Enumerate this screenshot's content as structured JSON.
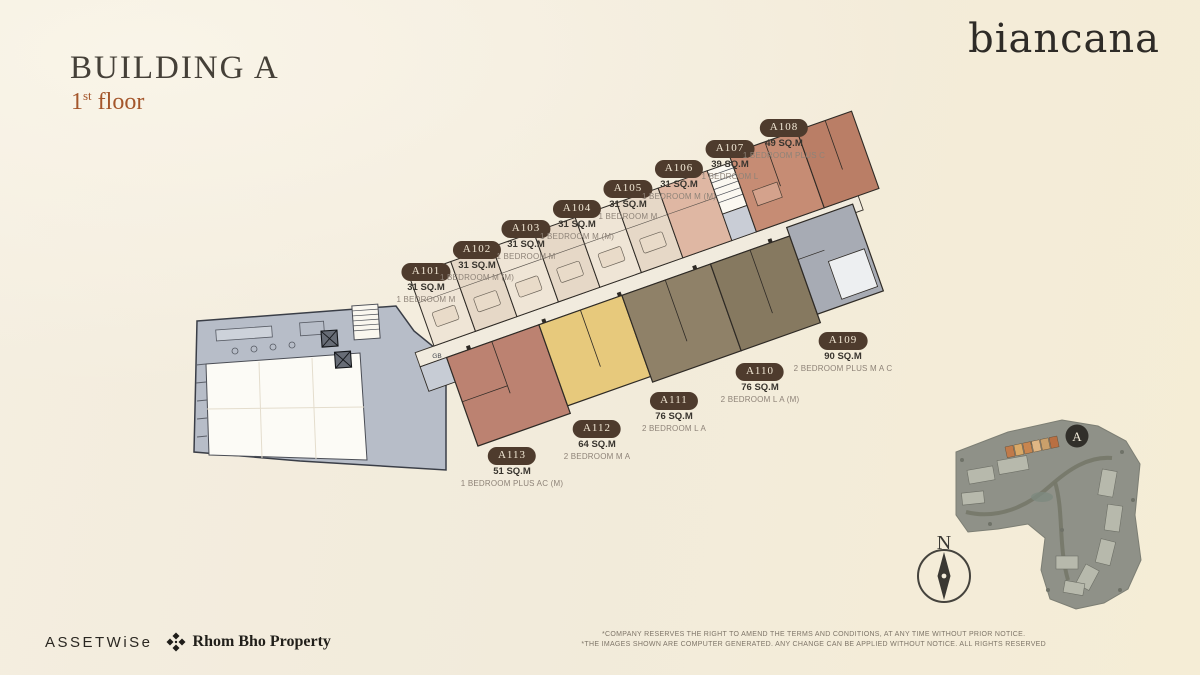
{
  "header": {
    "title": "BUILDING A",
    "floor_number": "1",
    "floor_ordinal": "st",
    "floor_word": "floor"
  },
  "brand": {
    "name": "biancana"
  },
  "units": [
    {
      "id": "A101",
      "sqm": "31 SQ.M",
      "type": "1 BEDROOM M"
    },
    {
      "id": "A102",
      "sqm": "31 SQ.M",
      "type": "1 BEDROOM M (M)"
    },
    {
      "id": "A103",
      "sqm": "31 SQ.M",
      "type": "1 BEDROOM M"
    },
    {
      "id": "A104",
      "sqm": "31 SQ.M",
      "type": "1 BEDROOM M (M)"
    },
    {
      "id": "A105",
      "sqm": "31 SQ.M",
      "type": "1 BEDROOM M"
    },
    {
      "id": "A106",
      "sqm": "31 SQ.M",
      "type": "1 BEDROOM M (M)"
    },
    {
      "id": "A107",
      "sqm": "39 SQ.M",
      "type": "1 BEDROOM L"
    },
    {
      "id": "A108",
      "sqm": "49 SQ.M",
      "type": "1 BEDROOM PLUS C"
    },
    {
      "id": "A109",
      "sqm": "90 SQ.M",
      "type": "2 BEDROOM PLUS M A C"
    },
    {
      "id": "A110",
      "sqm": "76 SQ.M",
      "type": "2 BEDROOM L A (M)"
    },
    {
      "id": "A111",
      "sqm": "76 SQ.M",
      "type": "2 BEDROOM L A"
    },
    {
      "id": "A112",
      "sqm": "64 SQ.M",
      "type": "2 BEDROOM M A"
    },
    {
      "id": "A113",
      "sqm": "51 SQ.M",
      "type": "1 BEDROOM PLUS AC (M)"
    }
  ],
  "plan": {
    "gb_label": "GB",
    "compass_north_label": "N",
    "site_badge_label": "A"
  },
  "footer": {
    "assetwise_logo": "ASSETWiSe",
    "partner_logo": "Rhom Bho Property",
    "disclaimer_line1": "*COMPANY RESERVES THE RIGHT TO AMEND THE TERMS AND CONDITIONS, AT ANY TIME WITHOUT PRIOR NOTICE.",
    "disclaimer_line2": "*THE IMAGES SHOWN ARE COMPUTER GENERATED. ANY CHANGE CAN BE APPLIED WITHOUT NOTICE. ALL RIGHTS RESERVED"
  },
  "colors": {
    "badge_brown": "#4e3b2d",
    "title_dark": "#454038",
    "floor_accent": "#a4562b",
    "background_cream": "#f3ecdd",
    "unit_cream": "#eee4d5",
    "unit_salmon": "#c68c74",
    "unit_gray": "#a7abb4",
    "unit_brown": "#8f8168",
    "unit_yellow": "#e7c97c",
    "unit_terracotta": "#bc8271",
    "podium_gray": "#b7bdc8"
  }
}
